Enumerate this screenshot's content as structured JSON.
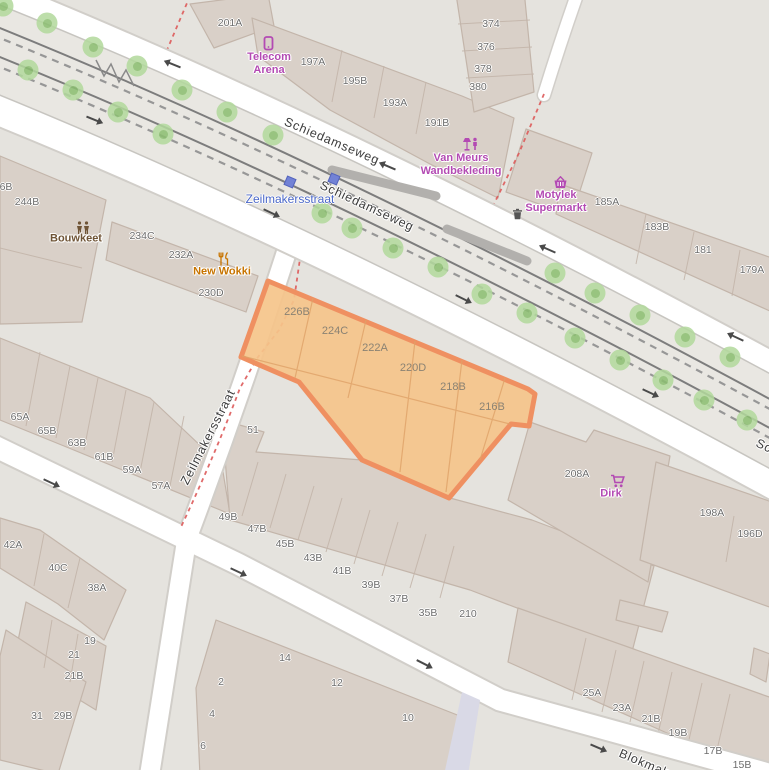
{
  "app": {
    "title": "OpenStreetMap view — Schiedamseweg area"
  },
  "theme": {
    "land": "#e5e3de",
    "building": "#d9d0c8",
    "road": "#ffffff",
    "selection_fill": "#f5c48a",
    "selection_stroke": "#ef9061",
    "boundary_red": "#dd5a5a",
    "tree_green": "#b2d99c",
    "shop_purple": "#b34ab3",
    "food_orange": "#c77400",
    "community_brown": "#6f5436",
    "transit_blue": "#4a67c8"
  },
  "map": {
    "street_labels": [
      {
        "text": "Schiedamseweg",
        "x": 332,
        "y": 141,
        "rot": 23
      },
      {
        "text": "Schiedamseweg",
        "x": 367,
        "y": 206,
        "rot": 25
      },
      {
        "text": "Schiedamseweg",
        "x": 803,
        "y": 464,
        "rot": 25
      },
      {
        "text": "Zeilmakersstraat",
        "x": 208,
        "y": 437,
        "rot": -63
      },
      {
        "text": "Blokmakersstraat",
        "x": 670,
        "y": 774,
        "rot": 23
      }
    ],
    "transit_stop": {
      "label": "Zeilmakersstraat",
      "x": 290,
      "y": 199,
      "markers": [
        {
          "x": 290,
          "y": 182
        },
        {
          "x": 334,
          "y": 179
        }
      ]
    },
    "selection": {
      "labels": [
        {
          "text": "226B",
          "x": 297,
          "y": 312
        },
        {
          "text": "224C",
          "x": 335,
          "y": 331
        },
        {
          "text": "222A",
          "x": 375,
          "y": 348
        },
        {
          "text": "220D",
          "x": 413,
          "y": 368
        },
        {
          "text": "218B",
          "x": 453,
          "y": 387
        },
        {
          "text": "216B",
          "x": 492,
          "y": 407
        }
      ]
    },
    "house_numbers": [
      {
        "text": "201A",
        "x": 230,
        "y": 23
      },
      {
        "text": "374",
        "x": 491,
        "y": 24
      },
      {
        "text": "376",
        "x": 486,
        "y": 47
      },
      {
        "text": "378",
        "x": 483,
        "y": 69
      },
      {
        "text": "380",
        "x": 478,
        "y": 87
      },
      {
        "text": "197A",
        "x": 313,
        "y": 62
      },
      {
        "text": "195B",
        "x": 355,
        "y": 81
      },
      {
        "text": "193A",
        "x": 395,
        "y": 103
      },
      {
        "text": "191B",
        "x": 437,
        "y": 123
      },
      {
        "text": "185A",
        "x": 607,
        "y": 202
      },
      {
        "text": "183B",
        "x": 657,
        "y": 227
      },
      {
        "text": "181",
        "x": 703,
        "y": 250
      },
      {
        "text": "179A",
        "x": 752,
        "y": 270
      },
      {
        "text": "6B",
        "x": 6,
        "y": 187
      },
      {
        "text": "244B",
        "x": 27,
        "y": 202
      },
      {
        "text": "234C",
        "x": 142,
        "y": 236
      },
      {
        "text": "232A",
        "x": 181,
        "y": 255
      },
      {
        "text": "230D",
        "x": 211,
        "y": 293
      },
      {
        "text": "51",
        "x": 253,
        "y": 430
      },
      {
        "text": "65A",
        "x": 20,
        "y": 417
      },
      {
        "text": "65B",
        "x": 47,
        "y": 431
      },
      {
        "text": "63B",
        "x": 77,
        "y": 443
      },
      {
        "text": "61B",
        "x": 104,
        "y": 457
      },
      {
        "text": "59A",
        "x": 132,
        "y": 470
      },
      {
        "text": "57A",
        "x": 161,
        "y": 486
      },
      {
        "text": "49B",
        "x": 228,
        "y": 517
      },
      {
        "text": "47B",
        "x": 257,
        "y": 529
      },
      {
        "text": "45B",
        "x": 285,
        "y": 544
      },
      {
        "text": "43B",
        "x": 313,
        "y": 558
      },
      {
        "text": "41B",
        "x": 342,
        "y": 571
      },
      {
        "text": "39B",
        "x": 371,
        "y": 585
      },
      {
        "text": "37B",
        "x": 399,
        "y": 599
      },
      {
        "text": "35B",
        "x": 428,
        "y": 613
      },
      {
        "text": "210",
        "x": 468,
        "y": 614
      },
      {
        "text": "208A",
        "x": 577,
        "y": 474
      },
      {
        "text": "198A",
        "x": 712,
        "y": 513
      },
      {
        "text": "196D",
        "x": 750,
        "y": 534
      },
      {
        "text": "42A",
        "x": 13,
        "y": 545
      },
      {
        "text": "40C",
        "x": 58,
        "y": 568
      },
      {
        "text": "38A",
        "x": 97,
        "y": 588
      },
      {
        "text": "19",
        "x": 90,
        "y": 641
      },
      {
        "text": "21",
        "x": 74,
        "y": 655
      },
      {
        "text": "21B",
        "x": 74,
        "y": 676
      },
      {
        "text": "31",
        "x": 37,
        "y": 716
      },
      {
        "text": "29B",
        "x": 63,
        "y": 716
      },
      {
        "text": "14",
        "x": 285,
        "y": 658
      },
      {
        "text": "12",
        "x": 337,
        "y": 683
      },
      {
        "text": "2",
        "x": 221,
        "y": 682
      },
      {
        "text": "4",
        "x": 212,
        "y": 714
      },
      {
        "text": "6",
        "x": 203,
        "y": 746
      },
      {
        "text": "10",
        "x": 408,
        "y": 718
      },
      {
        "text": "25A",
        "x": 592,
        "y": 693
      },
      {
        "text": "23A",
        "x": 622,
        "y": 708
      },
      {
        "text": "21B",
        "x": 651,
        "y": 719
      },
      {
        "text": "19B",
        "x": 678,
        "y": 733
      },
      {
        "text": "17B",
        "x": 713,
        "y": 751
      },
      {
        "text": "15B",
        "x": 742,
        "y": 765
      }
    ],
    "pois": [
      {
        "id": "telecom-arena",
        "icon": "phone-icon",
        "color": "shop",
        "icon_x": 262,
        "icon_y": 36,
        "label_x": 269,
        "label_y": 64,
        "lines": [
          "Telecom",
          "Arena"
        ]
      },
      {
        "id": "van-meurs",
        "icon": "homeware-icon",
        "color": "shop",
        "icon_x": 462,
        "icon_y": 137,
        "label_x": 461,
        "label_y": 165,
        "lines": [
          "Van Meurs",
          "Wandbekleding"
        ]
      },
      {
        "id": "motylek",
        "icon": "basket-icon",
        "color": "shop",
        "icon_x": 553,
        "icon_y": 176,
        "label_x": 556,
        "label_y": 202,
        "lines": [
          "Motylek",
          "Supermarkt"
        ]
      },
      {
        "id": "dirk",
        "icon": "cart-icon",
        "color": "shop",
        "icon_x": 610,
        "icon_y": 474,
        "label_x": 611,
        "label_y": 494,
        "lines": [
          "Dirk"
        ]
      },
      {
        "id": "new-wokki",
        "icon": "restaurant-icon",
        "color": "food",
        "icon_x": 218,
        "icon_y": 252,
        "label_x": 222,
        "label_y": 272,
        "lines": [
          "New Wokki"
        ]
      },
      {
        "id": "bouwkeet",
        "icon": "people-icon",
        "color": "community",
        "icon_x": 75,
        "icon_y": 221,
        "label_x": 76,
        "label_y": 239,
        "lines": [
          "Bouwkeet"
        ]
      },
      {
        "id": "waste-basket",
        "icon": "bin-icon",
        "color": "grey",
        "icon_x": 512,
        "icon_y": 208,
        "lines": []
      }
    ],
    "trees": [
      {
        "x": 3,
        "y": 6
      },
      {
        "x": 47,
        "y": 23
      },
      {
        "x": 93,
        "y": 47
      },
      {
        "x": 137,
        "y": 66
      },
      {
        "x": 182,
        "y": 90
      },
      {
        "x": 227,
        "y": 112
      },
      {
        "x": 273,
        "y": 135
      },
      {
        "x": 555,
        "y": 273
      },
      {
        "x": 595,
        "y": 293
      },
      {
        "x": 640,
        "y": 315
      },
      {
        "x": 685,
        "y": 337
      },
      {
        "x": 730,
        "y": 357
      },
      {
        "x": 28,
        "y": 70
      },
      {
        "x": 73,
        "y": 90
      },
      {
        "x": 118,
        "y": 112
      },
      {
        "x": 163,
        "y": 134
      },
      {
        "x": 322,
        "y": 213
      },
      {
        "x": 352,
        "y": 228
      },
      {
        "x": 393,
        "y": 248
      },
      {
        "x": 438,
        "y": 267
      },
      {
        "x": 482,
        "y": 294
      },
      {
        "x": 527,
        "y": 313
      },
      {
        "x": 575,
        "y": 338
      },
      {
        "x": 620,
        "y": 360
      },
      {
        "x": 663,
        "y": 380
      },
      {
        "x": 704,
        "y": 400
      },
      {
        "x": 747,
        "y": 420
      }
    ],
    "arrows": [
      {
        "x": 93,
        "y": 119,
        "rot": 22
      },
      {
        "x": 270,
        "y": 212,
        "rot": 25
      },
      {
        "x": 462,
        "y": 298,
        "rot": 26
      },
      {
        "x": 649,
        "y": 392,
        "rot": 25
      },
      {
        "x": 50,
        "y": 482,
        "rot": 25
      },
      {
        "x": 237,
        "y": 571,
        "rot": 25
      },
      {
        "x": 423,
        "y": 663,
        "rot": 27
      },
      {
        "x": 597,
        "y": 747,
        "rot": 23
      },
      {
        "x": 175,
        "y": 65,
        "rot": 202
      },
      {
        "x": 390,
        "y": 167,
        "rot": 203
      },
      {
        "x": 550,
        "y": 250,
        "rot": 204
      },
      {
        "x": 738,
        "y": 338,
        "rot": 205
      }
    ]
  }
}
